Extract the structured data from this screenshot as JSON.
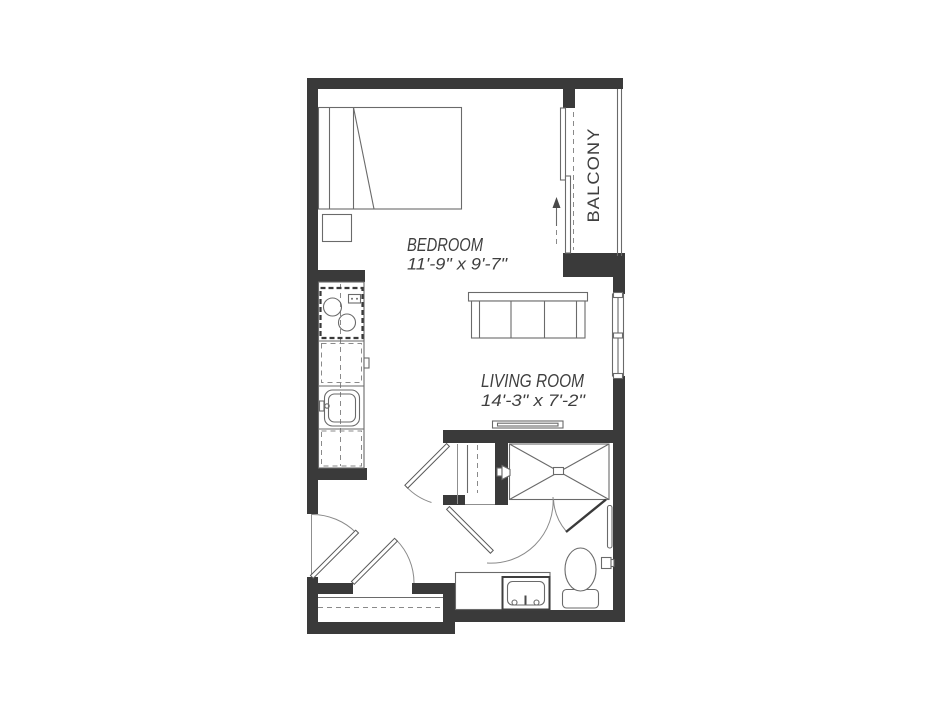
{
  "page": {
    "title": "Studio Apartment Floor Plan"
  },
  "colors": {
    "wall": "#3a3a3a",
    "fixture_line": "#6a6a6a",
    "dark_line": "#4a4a4a",
    "text": "#3f3f3f",
    "background": "#ffffff"
  },
  "rooms": {
    "bedroom": {
      "name": "BEDROOM",
      "dimensions": "11'-9\" x 9'-7\""
    },
    "living_room": {
      "name": "LIVING ROOM",
      "dimensions": "14'-3\" x 7'-2\""
    },
    "balcony": {
      "name": "BALCONY"
    }
  },
  "fixtures": [
    "bed",
    "nightstand",
    "kitchen-stove",
    "kitchen-counter",
    "kitchen-sink",
    "sofa",
    "tv-console",
    "balcony-sliding-door",
    "slide-direction-arrow",
    "balcony-railing",
    "living-room-window",
    "hall-closet",
    "closet-rod",
    "closet-shelf",
    "entry-door",
    "closet-door",
    "hall-closet-door",
    "bathroom-door",
    "shower",
    "shower-head",
    "shower-glass-door",
    "vanity-sink",
    "toilet",
    "towel-bar",
    "toilet-paper-holder"
  ]
}
